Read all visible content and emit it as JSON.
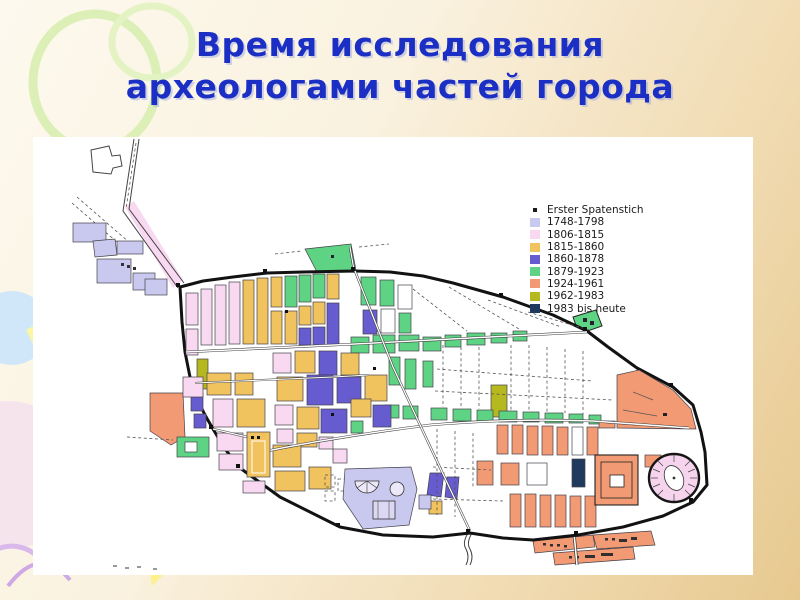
{
  "slide": {
    "title_line1": "Время исследования",
    "title_line2": "археологами частей города"
  },
  "colors": {
    "title": "#1b2fc4",
    "background_top": "#fdf9ee",
    "background_bottom": "#e7c98f",
    "panel": "#ffffff"
  },
  "legend": {
    "items": [
      {
        "label": "Erster Spatenstich",
        "swatch": "dot",
        "color": "#1a1a1a"
      },
      {
        "label": "1748-1798",
        "swatch": "square",
        "color": "#c9c9ef"
      },
      {
        "label": "1806-1815",
        "swatch": "square",
        "color": "#f9d9f1"
      },
      {
        "label": "1815-1860",
        "swatch": "square",
        "color": "#f1c35e"
      },
      {
        "label": "1860-1878",
        "swatch": "square",
        "color": "#675bd0"
      },
      {
        "label": "1879-1923",
        "swatch": "square",
        "color": "#5ed383"
      },
      {
        "label": "1924-1961",
        "swatch": "square",
        "color": "#f19a73"
      },
      {
        "label": "1962-1983",
        "swatch": "square",
        "color": "#b6b81f"
      },
      {
        "label": "1983 bis heute",
        "swatch": "square",
        "color": "#203a5e"
      }
    ]
  },
  "map": {
    "description": "Plan of Pompeii, city districts colored by period of archaeological excavation"
  }
}
